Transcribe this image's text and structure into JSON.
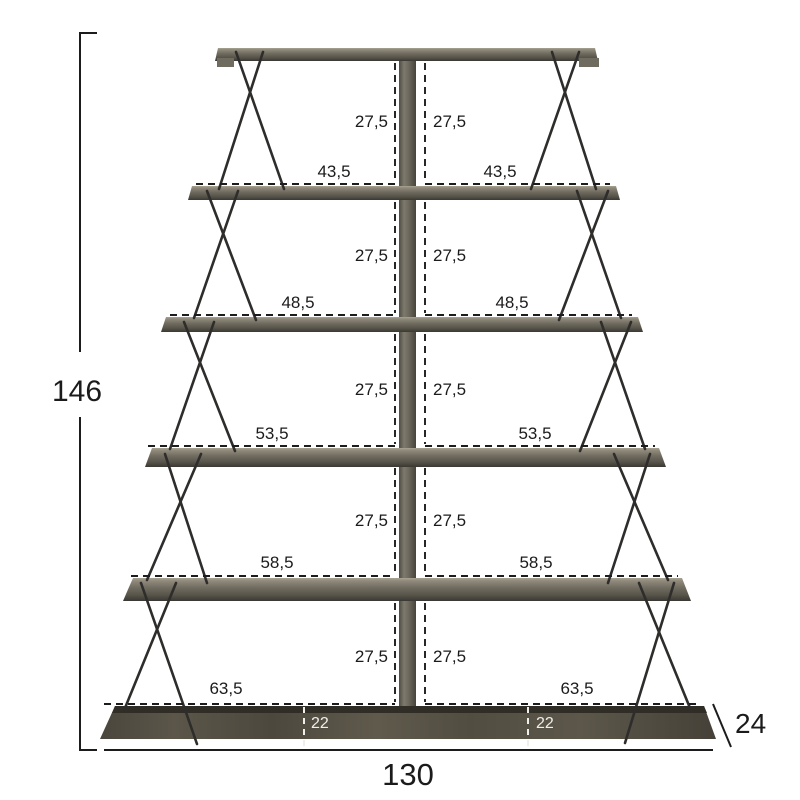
{
  "overall": {
    "height": "146",
    "width": "130",
    "depth": "24"
  },
  "compartments": [
    {
      "height": "27,5",
      "width": "43,5"
    },
    {
      "height": "27,5",
      "width": "48,5"
    },
    {
      "height": "27,5",
      "width": "53,5"
    },
    {
      "height": "27,5",
      "width": "58,5"
    },
    {
      "height": "27,5",
      "width": "63,5"
    }
  ],
  "base": {
    "inset_left": "22",
    "inset_right": "22"
  },
  "colors": {
    "guide": "#1c1c1c",
    "frame": "#2e2d2b",
    "label_text": "#1b1b1b",
    "base_guide": "#efeee9"
  }
}
